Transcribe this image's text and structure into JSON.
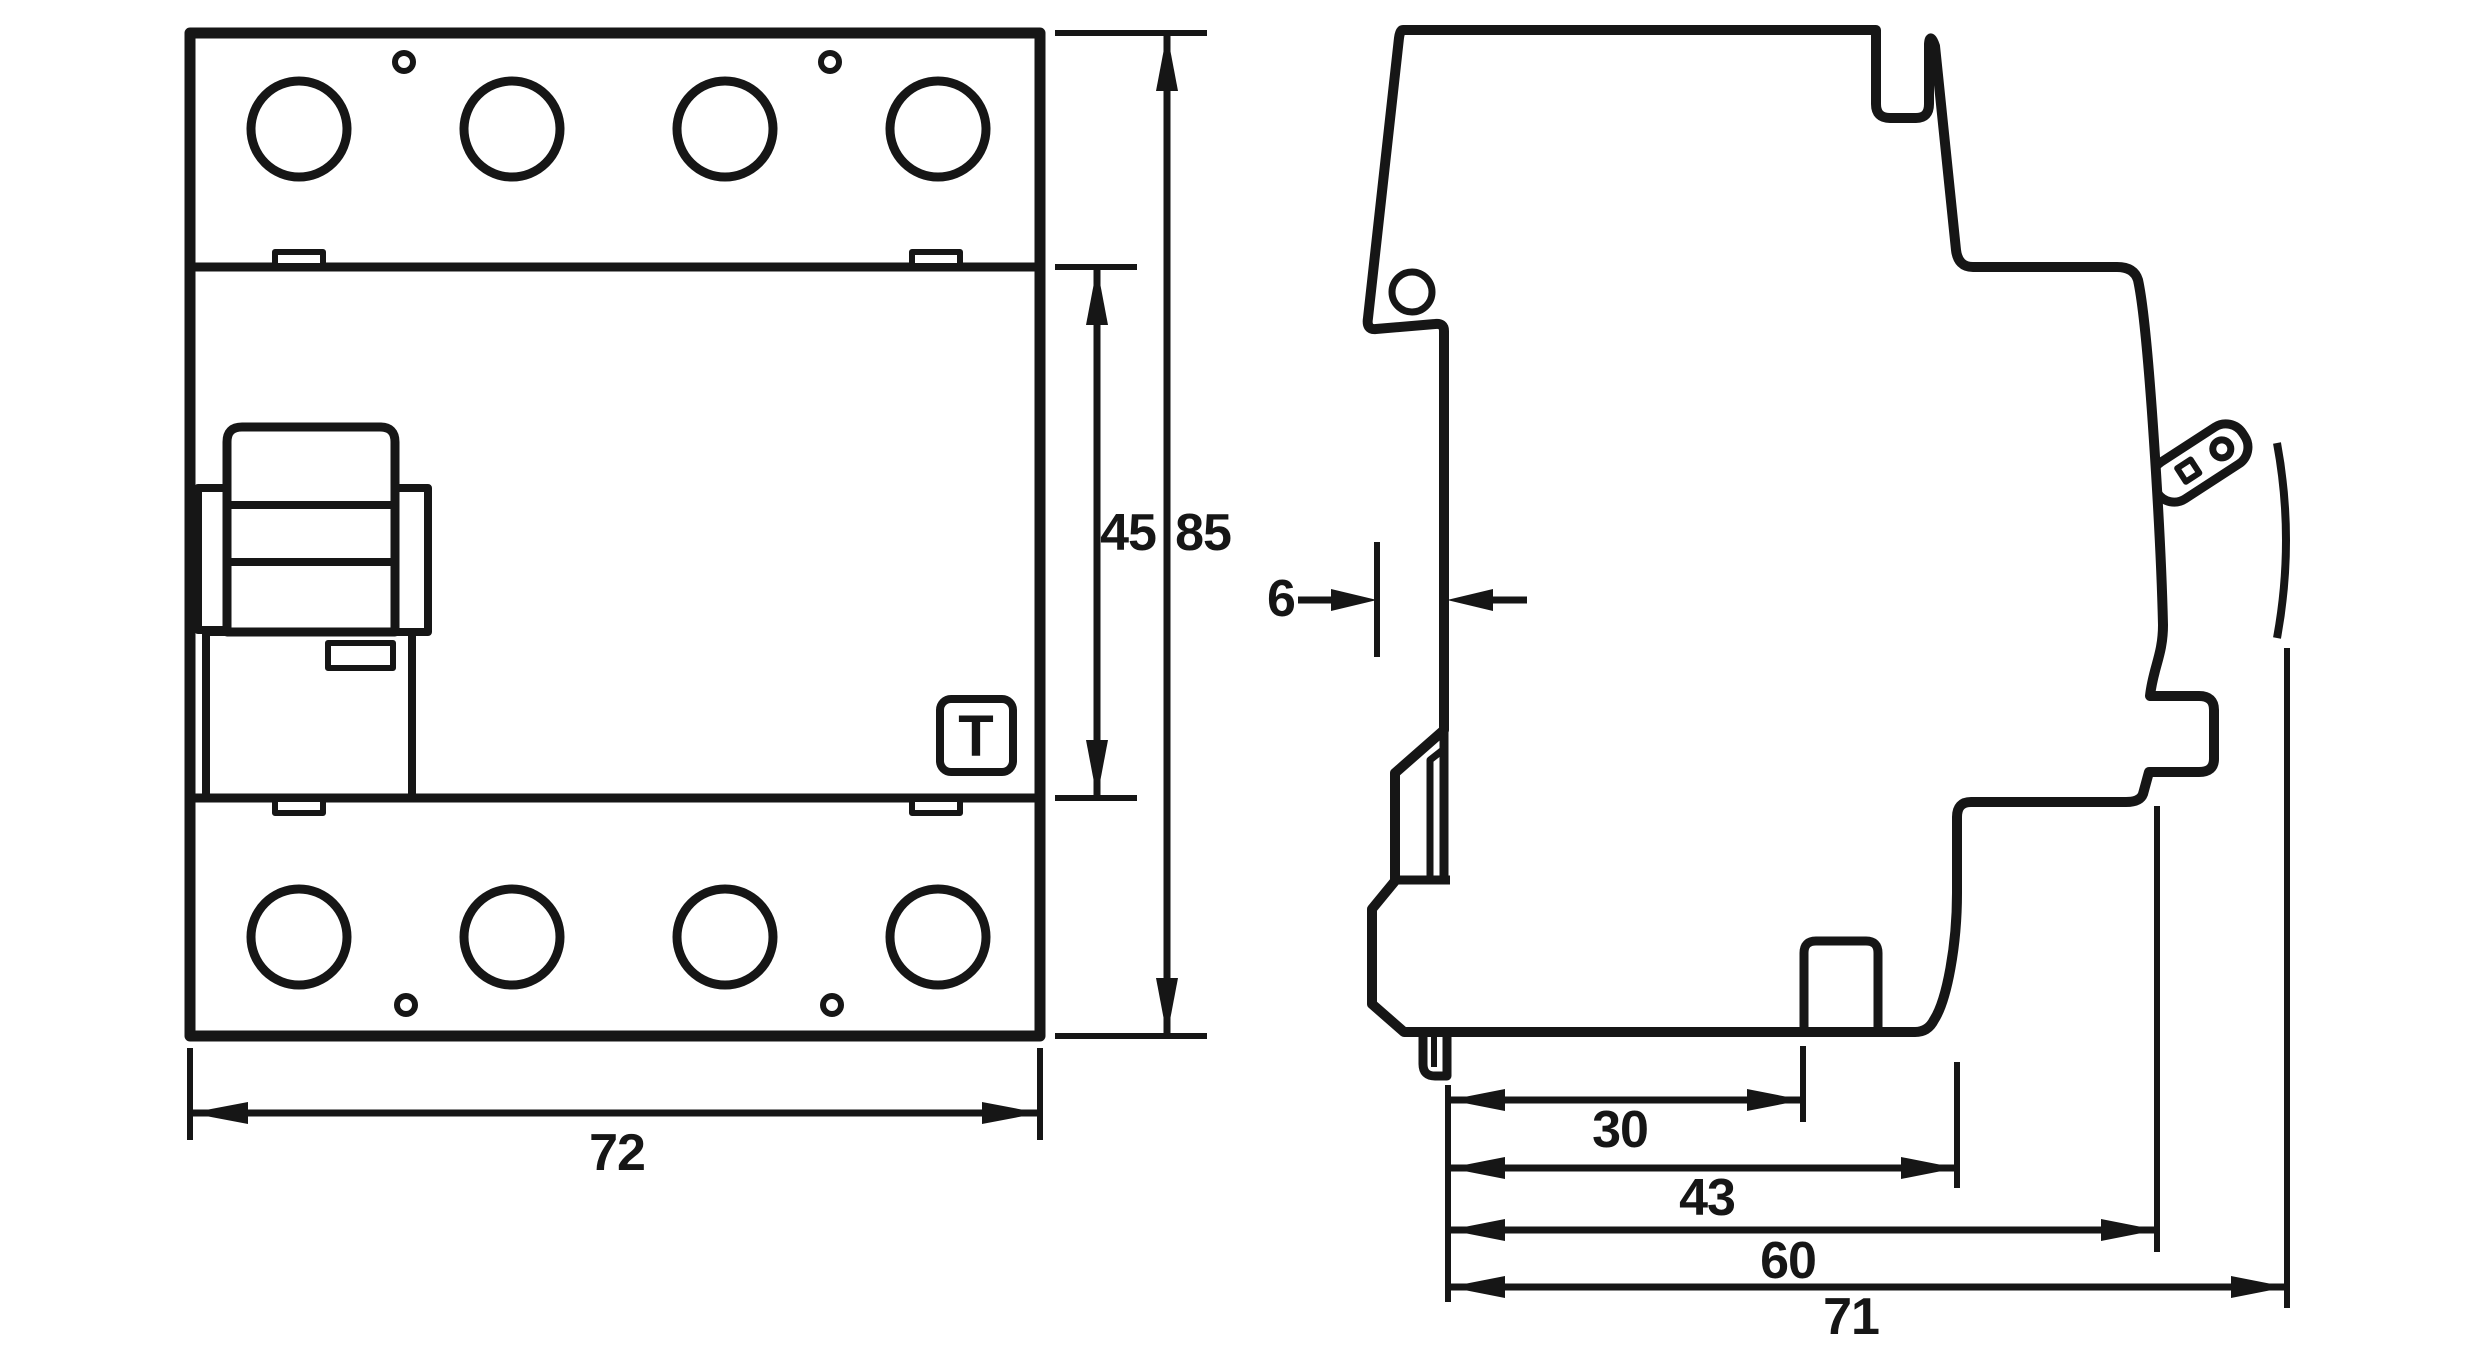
{
  "drawing": {
    "kind": "technical dimension drawing of DIN-rail residual current circuit breaker, front and side view",
    "unit": "mm",
    "colors": {
      "line": "#161616",
      "background": "#ffffff"
    }
  },
  "labels": {
    "front_width": "72",
    "front_section_height": "45",
    "front_total_height": "85",
    "side_rear_offset": "6",
    "side_claw_to_guide": "30",
    "side_body_depth": "43",
    "side_front_depth": "60",
    "side_total_depth": "71",
    "test_button": "T"
  }
}
